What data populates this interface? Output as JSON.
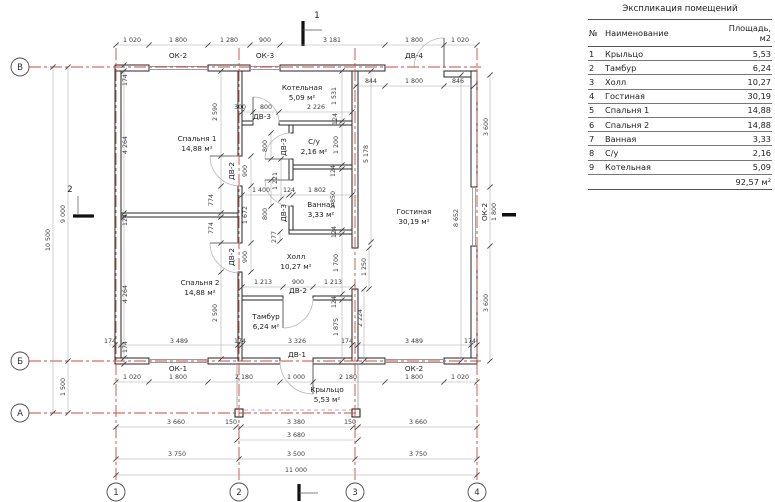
{
  "colors": {
    "axis_red": "#cf4a3c",
    "wall": "#262626",
    "dim_text": "#3a3a3a"
  },
  "table": {
    "title": "Экспликация помещений",
    "columns": [
      "№",
      "Наименование",
      "Площадь, м2"
    ],
    "rows": [
      [
        "1",
        "Крыльцо",
        "5,53"
      ],
      [
        "2",
        "Тамбур",
        "6,24"
      ],
      [
        "3",
        "Холл",
        "10,27"
      ],
      [
        "4",
        "Гостиная",
        "30,19"
      ],
      [
        "5",
        "Спальня 1",
        "14,88"
      ],
      [
        "6",
        "Спальня 2",
        "14,88"
      ],
      [
        "7",
        "Ванная",
        "3,33"
      ],
      [
        "8",
        "С/у",
        "2,16"
      ],
      [
        "9",
        "Котельная",
        "5,09"
      ]
    ],
    "total": "92,57 м²"
  },
  "plan": {
    "grid_cols": [
      "1",
      "2",
      "3",
      "4"
    ],
    "grid_rows": [
      "В",
      "Б",
      "А"
    ],
    "rooms": [
      {
        "name": "Спальня 1",
        "area": "14,88 м²",
        "x": 197,
        "y": 141
      },
      {
        "name": "Спальня 2",
        "area": "14,88 м²",
        "x": 200,
        "y": 285
      },
      {
        "name": "Котельная",
        "area": "5,09 м²",
        "x": 302,
        "y": 90
      },
      {
        "name": "С/у",
        "area": "2,16 м²",
        "x": 314,
        "y": 144
      },
      {
        "name": "Ванная",
        "area": "3,33 м²",
        "x": 321,
        "y": 207
      },
      {
        "name": "Холл",
        "area": "10,27 м²",
        "x": 296,
        "y": 259
      },
      {
        "name": "Тамбур",
        "area": "6,24 м²",
        "x": 266,
        "y": 319
      },
      {
        "name": "Гостиная",
        "area": "30,19 м²",
        "x": 414,
        "y": 214
      },
      {
        "name": "Крыльцо",
        "area": "5,53 м²",
        "x": 327,
        "y": 392
      }
    ],
    "labels": [
      {
        "t": "ОК-2",
        "x": 178,
        "y": 58
      },
      {
        "t": "ОК-3",
        "x": 265,
        "y": 58
      },
      {
        "t": "ДВ-4",
        "x": 414,
        "y": 58
      },
      {
        "t": "ОК-1",
        "x": 178,
        "y": 371
      },
      {
        "t": "ОК-2",
        "x": 414,
        "y": 371
      },
      {
        "t": "ДВ-1",
        "x": 297,
        "y": 357
      },
      {
        "t": "ДВ-2",
        "x": 298,
        "y": 293
      },
      {
        "t": "ДВ-3",
        "x": 262,
        "y": 119
      },
      {
        "t": "ДВ-2",
        "x": 234,
        "y": 171,
        "r": 1
      },
      {
        "t": "ДВ-2",
        "x": 234,
        "y": 257,
        "r": 1
      },
      {
        "t": "ДВ-3",
        "x": 286,
        "y": 147,
        "r": 1
      },
      {
        "t": "ДВ-3",
        "x": 286,
        "y": 213,
        "r": 1
      },
      {
        "t": "ОК-2",
        "x": 487,
        "y": 212,
        "r": 1
      }
    ],
    "section_marks": [
      {
        "t": "1",
        "x": 317,
        "y": 18
      },
      {
        "t": "2",
        "x": 70,
        "y": 192
      }
    ],
    "dims": [
      {
        "t": "1 020",
        "x": 132,
        "y": 42
      },
      {
        "t": "1 800",
        "x": 178,
        "y": 42
      },
      {
        "t": "1 280",
        "x": 229,
        "y": 42
      },
      {
        "t": "900",
        "x": 265,
        "y": 42
      },
      {
        "t": "3 181",
        "x": 332,
        "y": 42
      },
      {
        "t": "1 800",
        "x": 414,
        "y": 42
      },
      {
        "t": "1 020",
        "x": 460,
        "y": 42
      },
      {
        "t": "844",
        "x": 371,
        "y": 83
      },
      {
        "t": "1 800",
        "x": 414,
        "y": 83
      },
      {
        "t": "846",
        "x": 458,
        "y": 83
      },
      {
        "t": "300",
        "x": 240,
        "y": 109
      },
      {
        "t": "800",
        "x": 266,
        "y": 109
      },
      {
        "t": "2 226",
        "x": 316,
        "y": 109
      },
      {
        "t": "1 400",
        "x": 261,
        "y": 192
      },
      {
        "t": "124",
        "x": 289,
        "y": 192
      },
      {
        "t": "1 802",
        "x": 317,
        "y": 192
      },
      {
        "t": "1 213",
        "x": 263,
        "y": 284
      },
      {
        "t": "900",
        "x": 298,
        "y": 284
      },
      {
        "t": "1 213",
        "x": 333,
        "y": 284
      },
      {
        "t": "174",
        "x": 110,
        "y": 343
      },
      {
        "t": "3 489",
        "x": 179,
        "y": 343
      },
      {
        "t": "174",
        "x": 240,
        "y": 343
      },
      {
        "t": "3 326",
        "x": 297,
        "y": 343
      },
      {
        "t": "174",
        "x": 347,
        "y": 343
      },
      {
        "t": "3 489",
        "x": 414,
        "y": 343
      },
      {
        "t": "174",
        "x": 470,
        "y": 343
      },
      {
        "t": "1 020",
        "x": 132,
        "y": 379
      },
      {
        "t": "1 800",
        "x": 178,
        "y": 379
      },
      {
        "t": "2 180",
        "x": 244,
        "y": 379
      },
      {
        "t": "1 000",
        "x": 296,
        "y": 379
      },
      {
        "t": "2 180",
        "x": 348,
        "y": 379
      },
      {
        "t": "1 800",
        "x": 414,
        "y": 379
      },
      {
        "t": "1 020",
        "x": 460,
        "y": 379
      },
      {
        "t": "3 660",
        "x": 176,
        "y": 424
      },
      {
        "t": "150",
        "x": 231,
        "y": 424
      },
      {
        "t": "3 380",
        "x": 296,
        "y": 424
      },
      {
        "t": "150",
        "x": 350,
        "y": 424
      },
      {
        "t": "3 660",
        "x": 418,
        "y": 424
      },
      {
        "t": "3 680",
        "x": 296,
        "y": 437
      },
      {
        "t": "3 750",
        "x": 177,
        "y": 456
      },
      {
        "t": "3 500",
        "x": 296,
        "y": 456
      },
      {
        "t": "3 750",
        "x": 418,
        "y": 456
      },
      {
        "t": "11 000",
        "x": 296,
        "y": 472
      },
      {
        "t": "174",
        "x": 127,
        "y": 80,
        "r": 1
      },
      {
        "t": "4 264",
        "x": 127,
        "y": 145,
        "r": 1
      },
      {
        "t": "124",
        "x": 127,
        "y": 220,
        "r": 1
      },
      {
        "t": "4 264",
        "x": 127,
        "y": 294,
        "r": 1
      },
      {
        "t": "174",
        "x": 127,
        "y": 347,
        "r": 1
      },
      {
        "t": "10 500",
        "x": 50,
        "y": 240,
        "r": 1
      },
      {
        "t": "9 000",
        "x": 65,
        "y": 214,
        "r": 1
      },
      {
        "t": "1 500",
        "x": 65,
        "y": 387,
        "r": 1
      },
      {
        "t": "2 590",
        "x": 217,
        "y": 112,
        "r": 1
      },
      {
        "t": "900",
        "x": 247,
        "y": 171,
        "r": 1
      },
      {
        "t": "774",
        "x": 213,
        "y": 200,
        "r": 1
      },
      {
        "t": "774",
        "x": 213,
        "y": 228,
        "r": 1
      },
      {
        "t": "1 672",
        "x": 247,
        "y": 215,
        "r": 1
      },
      {
        "t": "900",
        "x": 247,
        "y": 257,
        "r": 1
      },
      {
        "t": "2 590",
        "x": 217,
        "y": 313,
        "r": 1
      },
      {
        "t": "1 531",
        "x": 336,
        "y": 96,
        "r": 1
      },
      {
        "t": "124",
        "x": 337,
        "y": 119,
        "r": 1
      },
      {
        "t": "1 200",
        "x": 338,
        "y": 145,
        "r": 1
      },
      {
        "t": "124",
        "x": 335,
        "y": 171,
        "r": 1
      },
      {
        "t": "1 850",
        "x": 335,
        "y": 200,
        "r": 1
      },
      {
        "t": "124",
        "x": 336,
        "y": 232,
        "r": 1
      },
      {
        "t": "1 700",
        "x": 338,
        "y": 263,
        "r": 1
      },
      {
        "t": "124",
        "x": 336,
        "y": 302,
        "r": 1
      },
      {
        "t": "1 875",
        "x": 338,
        "y": 327,
        "r": 1
      },
      {
        "t": "1 221",
        "x": 277,
        "y": 181,
        "r": 1
      },
      {
        "t": "800",
        "x": 267,
        "y": 146,
        "r": 1
      },
      {
        "t": "800",
        "x": 267,
        "y": 214,
        "r": 1
      },
      {
        "t": "277",
        "x": 276,
        "y": 237,
        "r": 1
      },
      {
        "t": "5 178",
        "x": 368,
        "y": 154,
        "r": 1
      },
      {
        "t": "1 250",
        "x": 366,
        "y": 267,
        "r": 1
      },
      {
        "t": "2 224",
        "x": 362,
        "y": 318,
        "r": 1
      },
      {
        "t": "8 652",
        "x": 458,
        "y": 218,
        "r": 1
      },
      {
        "t": "3 600",
        "x": 488,
        "y": 127,
        "r": 1
      },
      {
        "t": "1 800",
        "x": 496,
        "y": 212,
        "r": 1
      },
      {
        "t": "3 600",
        "x": 488,
        "y": 303,
        "r": 1
      }
    ]
  }
}
